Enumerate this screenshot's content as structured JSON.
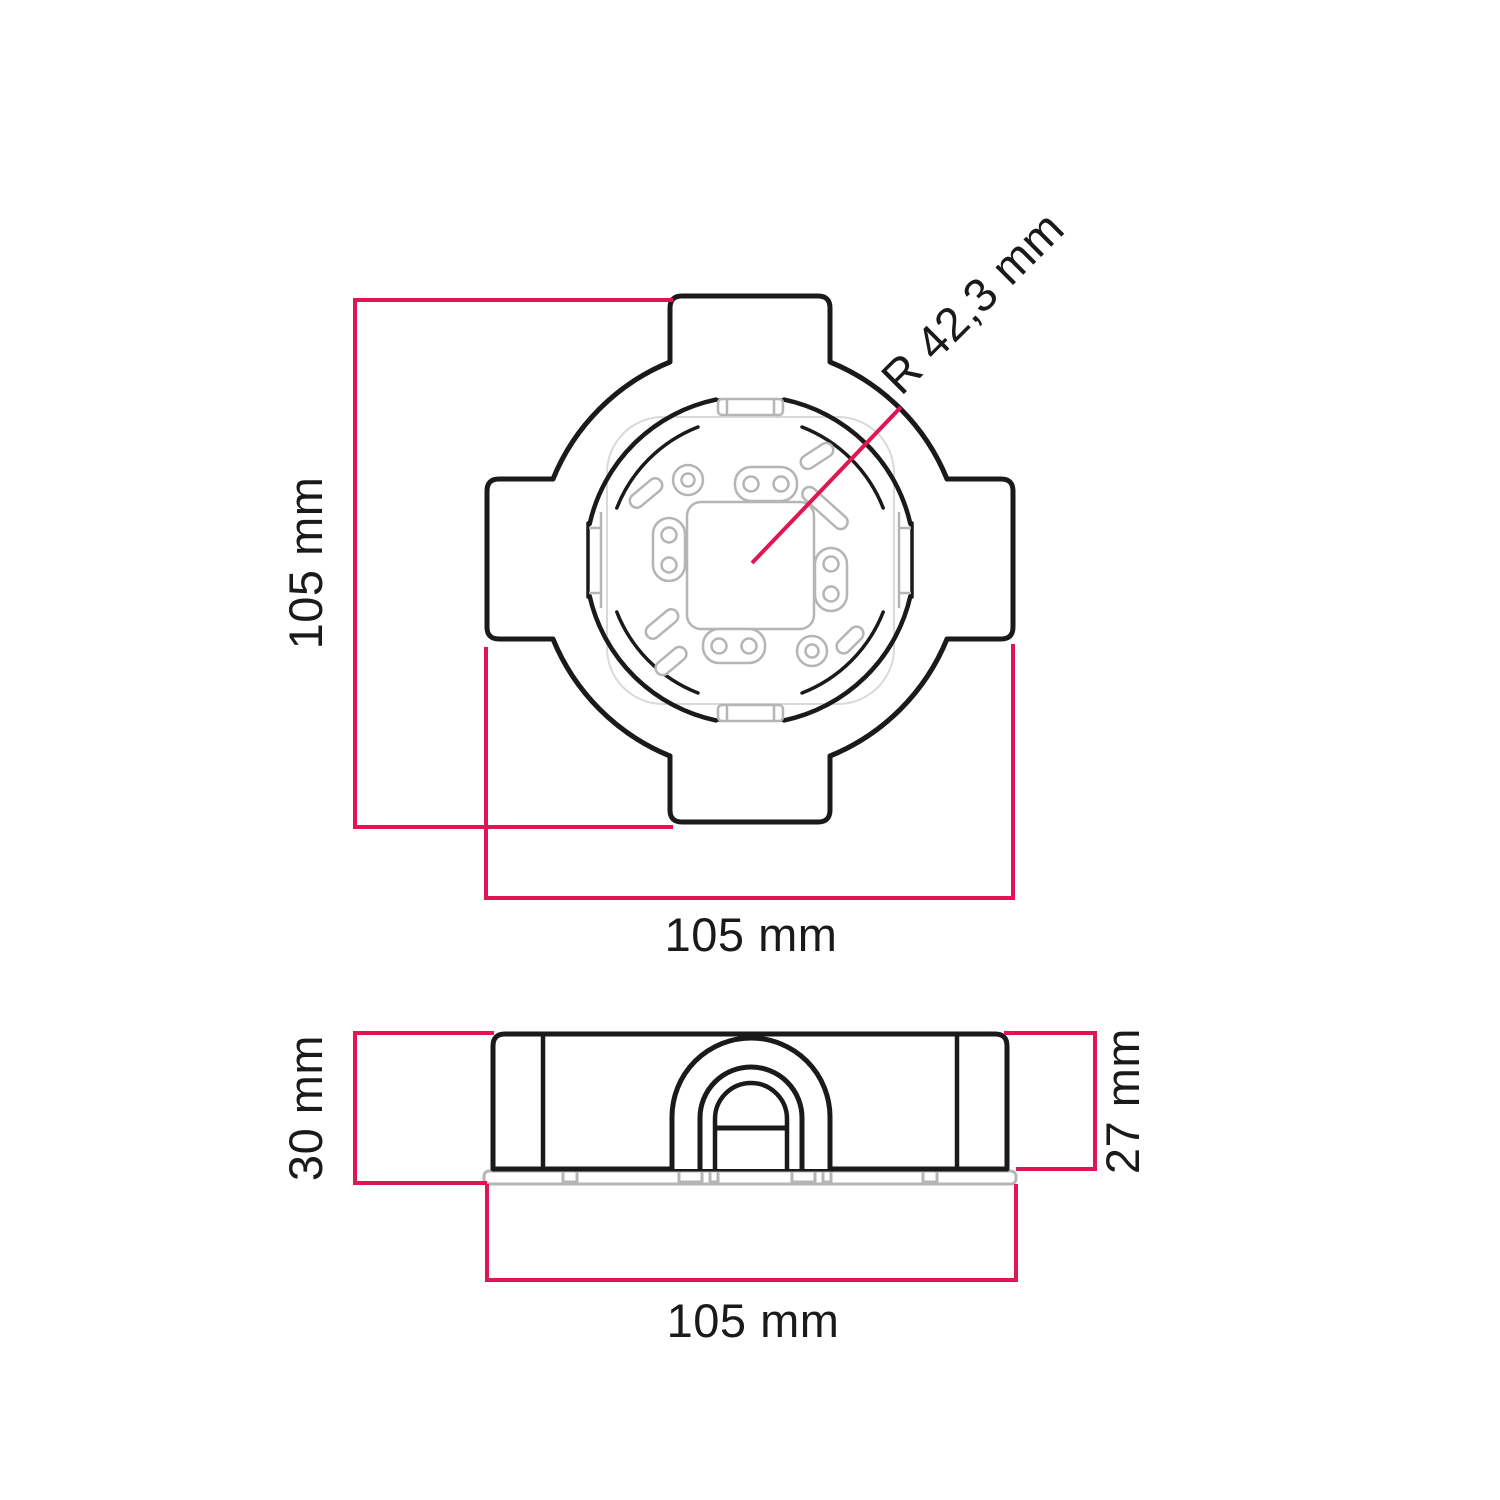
{
  "drawing": {
    "kind": "technical dimension drawing of a square ceiling mounting box (top view and side view)",
    "top_view": {
      "dim_height_label": "105 mm",
      "dim_width_label": "105 mm",
      "dim_radius_label": "R 42,3 mm"
    },
    "side_view": {
      "dim_height_with_plate_label": "30 mm",
      "dim_height_body_label": "27 mm",
      "dim_width_label": "105 mm"
    },
    "values": {
      "width_mm": 105,
      "height_mm": 105,
      "radius_mm": 42.3,
      "depth_with_plate_mm": 30,
      "depth_body_mm": 27
    }
  },
  "colors": {
    "outline": "#1a1a1a",
    "dimension": "#e11553",
    "detail": "#b5b5b5",
    "detail_faint": "#d9d9d9",
    "background": "#ffffff"
  }
}
